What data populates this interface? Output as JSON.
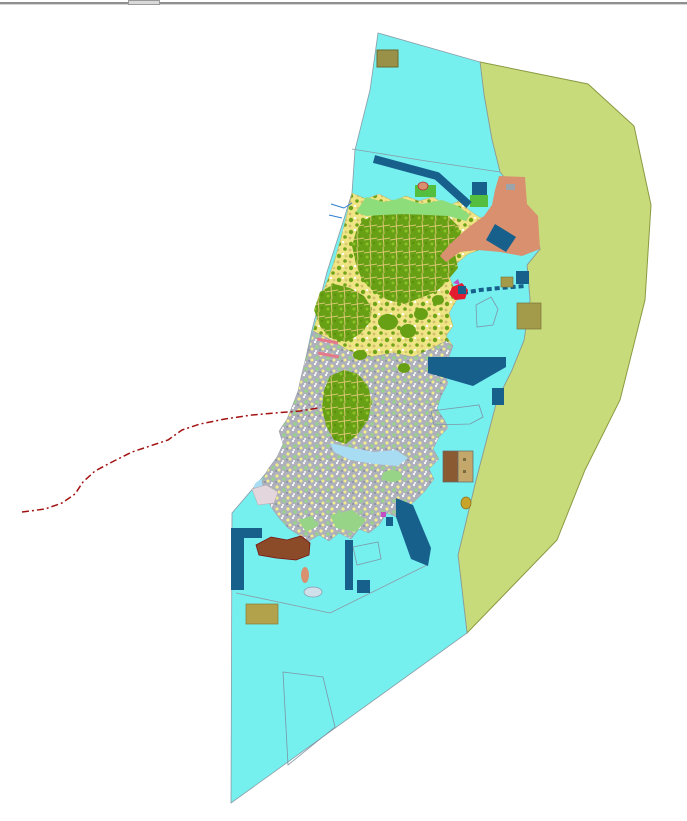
{
  "window": {
    "top_bar": {
      "handle": "window-resize-handle"
    }
  },
  "map": {
    "canvas": {
      "width": 687,
      "height": 821,
      "background": "#ffffff"
    },
    "palette": {
      "water": "#76EFEF",
      "reef": "#C7DB7B",
      "reef_border": "#8A9A42",
      "outline": "#8B9BA6",
      "harbor_blue": "#17608C",
      "salmon": "#D8906F",
      "khaki": "#A39A4A",
      "khaki_dark": "#9A9148",
      "khaki_light": "#B2A24B",
      "forest": "#67A014",
      "green_bright": "#54BE3E",
      "green_light": "#8EDD7B",
      "green_pale": "#98D488",
      "pale_blue": "#A8DCF2",
      "pale_pink": "#E3D6DC",
      "brown": "#8C4B28",
      "building_brown": "#8A5A33",
      "building_tan": "#C4A86B",
      "red_line": "#A31212",
      "pink_line": "#E4798C",
      "magenta": "#C24FC2",
      "red_feature": "#E31B2E",
      "stream_blue": "#2E7FD0",
      "gold": "#C9A42B"
    },
    "shapes": [
      {
        "name": "reef-zone",
        "kind": "polygon",
        "points": "480,62 484,95 492,140 500,172 510,185 520,200 532,215 540,249 527,265 530,300 524,340 512,370 497,400 476,480 458,555 467,633 557,540 585,470 620,400 645,300 651,205 634,126 588,84",
        "fill": "@reef",
        "stroke": "@reef_border",
        "sw": 1,
        "interactable": true
      },
      {
        "name": "lagoon-water",
        "kind": "polygon",
        "points": "378,33 480,62 484,95 492,140 500,172 510,185 520,200 532,215 540,249 527,265 530,300 524,340 512,370 497,400 476,480 458,555 467,633 231,803 232,513 262,478 305,425 300,385 312,330 327,272 343,222 352,193 355,150 370,90",
        "fill": "@water",
        "stroke": "@outline",
        "sw": 0.8,
        "interactable": true
      },
      {
        "name": "boundary-line-north",
        "kind": "polyline",
        "points": "352,149 420,160 500,172",
        "stroke": "@outline",
        "sw": 0.8,
        "interactable": false
      },
      {
        "name": "boundary-line-south",
        "kind": "polyline",
        "points": "236,593 330,613 427,565",
        "stroke": "@outline",
        "sw": 0.8,
        "interactable": false
      },
      {
        "name": "coastal-shallow-west-1",
        "kind": "ellipse",
        "cx": 270,
        "cy": 487,
        "rx": 16,
        "ry": 9,
        "fill": "@pale_blue",
        "interactable": false
      },
      {
        "name": "coastal-shallow-west-2",
        "kind": "ellipse",
        "cx": 291,
        "cy": 501,
        "rx": 12,
        "ry": 7,
        "fill": "@pale_blue",
        "interactable": false
      },
      {
        "name": "island-north",
        "kind": "polygon",
        "points": "352,193 366,199 379,194 393,201 406,196 419,201 433,197 448,206 459,201 469,210 479,217 492,220 497,228 489,238 479,250 468,254 456,264 449,276 453,286 463,293 456,301 449,313 453,326 446,336 453,346 446,341 431,349 413,357 393,353 371,357 349,351 331,340 313,331 318,314 321,297 328,279 335,259 341,238 346,218",
        "fill": "pattern:landmix",
        "stroke": "#b8b070",
        "sw": 0.5,
        "interactable": true
      },
      {
        "name": "island-south",
        "kind": "polygon",
        "points": "313,331 331,340 349,351 371,357 393,353 413,357 431,349 446,341 453,346 448,359 443,371 448,383 441,396 437,409 445,421 448,428 439,437 433,449 439,459 429,469 434,479 425,491 415,501 405,509 397,517 387,513 379,525 369,533 359,529 351,539 339,533 329,541 319,535 309,541 297,534 288,528 279,518 271,507 265,494 262,481 268,469 277,457 283,444 279,431 287,419 293,404 298,391 301,377 305,361 309,347",
        "fill": "pattern:urban",
        "stroke": "#9aa0a8",
        "sw": 0.5,
        "interactable": true
      },
      {
        "name": "inlet-shallow",
        "kind": "polygon",
        "points": "330,443 352,448 374,452 396,450 408,458 398,466 374,464 350,460 334,452",
        "fill": "@pale_blue",
        "interactable": false
      },
      {
        "name": "forest-patch-north-1",
        "kind": "polygon",
        "points": "362,221 378,213 396,210 414,214 432,210 448,216 458,226 462,240 455,254 458,268 448,280 436,292 420,298 404,304 388,300 374,292 362,280 356,264 352,246 356,232",
        "fill": "pattern:forest",
        "interactable": false
      },
      {
        "name": "forest-patch-north-2",
        "kind": "polygon",
        "points": "320,292 334,284 350,288 364,296 372,308 370,322 360,334 346,342 330,338 320,326 314,310",
        "fill": "pattern:forest",
        "interactable": false
      },
      {
        "name": "forest-patch-center",
        "kind": "polygon",
        "points": "330,376 344,370 358,374 368,386 372,402 368,420 358,434 346,444 334,440 326,426 322,408 324,390",
        "fill": "pattern:forest",
        "interactable": false
      },
      {
        "name": "forest-patch-small-1",
        "kind": "ellipse",
        "cx": 388,
        "cy": 322,
        "rx": 10,
        "ry": 8,
        "fill": "@forest",
        "interactable": false
      },
      {
        "name": "forest-patch-small-2",
        "kind": "ellipse",
        "cx": 408,
        "cy": 331,
        "rx": 8,
        "ry": 7,
        "fill": "@forest",
        "interactable": false
      },
      {
        "name": "forest-patch-small-3",
        "kind": "ellipse",
        "cx": 421,
        "cy": 314,
        "rx": 7,
        "ry": 6,
        "fill": "@forest",
        "interactable": false
      },
      {
        "name": "forest-patch-small-4",
        "kind": "ellipse",
        "cx": 438,
        "cy": 300,
        "rx": 6,
        "ry": 5,
        "fill": "@forest",
        "interactable": false
      },
      {
        "name": "forest-patch-small-5",
        "kind": "ellipse",
        "cx": 360,
        "cy": 355,
        "rx": 7,
        "ry": 5,
        "fill": "@forest",
        "interactable": false
      },
      {
        "name": "forest-patch-small-6",
        "kind": "ellipse",
        "cx": 404,
        "cy": 368,
        "rx": 6,
        "ry": 5,
        "fill": "@forest",
        "interactable": false
      },
      {
        "name": "coast-strip-green",
        "kind": "polygon",
        "points": "356,212 366,197 384,202 402,198 422,204 442,200 458,206 470,215 466,221 448,216 428,215 404,214 382,215 366,216",
        "fill": "@green_light",
        "interactable": false
      },
      {
        "name": "coastal-zone-northeast",
        "kind": "polygon",
        "points": "499,176 525,177 527,204 538,216 540,249 522,256 500,252 478,250 460,252 446,262 440,256 450,244 462,233 473,224 484,216 492,205 495,190",
        "fill": "@salmon",
        "interactable": true
      },
      {
        "name": "smudge-gray",
        "kind": "rect",
        "x": 506,
        "y": 184,
        "w": 9,
        "h": 6,
        "fill": "#9aa4aa",
        "interactable": false
      },
      {
        "name": "green-parcel-1",
        "kind": "rect",
        "x": 415,
        "y": 185,
        "w": 21,
        "h": 12,
        "fill": "@green_bright",
        "interactable": false
      },
      {
        "name": "green-parcel-2",
        "kind": "rect",
        "x": 470,
        "y": 195,
        "w": 18,
        "h": 12,
        "fill": "@green_bright",
        "interactable": false
      },
      {
        "name": "green-patch-south-1",
        "kind": "polygon",
        "points": "330,515 352,510 366,520 356,532 336,528",
        "fill": "@green_pale",
        "interactable": false
      },
      {
        "name": "green-patch-south-2",
        "kind": "polygon",
        "points": "298,520 312,516 318,526 306,532",
        "fill": "@green_pale",
        "interactable": false
      },
      {
        "name": "green-patch-south-3",
        "kind": "ellipse",
        "cx": 392,
        "cy": 476,
        "rx": 10,
        "ry": 6,
        "fill": "@green_pale",
        "interactable": false
      },
      {
        "name": "breakwater-northwest",
        "kind": "polyline",
        "points": "374,159 437,176 469,205",
        "stroke": "@harbor_blue",
        "sw": 8,
        "interactable": true
      },
      {
        "name": "marine-parcel-ne-1",
        "kind": "rect",
        "x": 472,
        "y": 182,
        "w": 15,
        "h": 13,
        "fill": "@harbor_blue",
        "interactable": false
      },
      {
        "name": "causeway",
        "kind": "polyline",
        "points": "463,293 480,290 500,288 525,286",
        "stroke": "@harbor_blue",
        "sw": 4,
        "dash": "5 3",
        "interactable": true
      },
      {
        "name": "marine-structure-ne",
        "kind": "rect",
        "x": 516,
        "y": 271,
        "w": 13,
        "h": 13,
        "fill": "@harbor_blue",
        "interactable": true
      },
      {
        "name": "khaki-parcel-small",
        "kind": "rect",
        "x": 501,
        "y": 277,
        "w": 12,
        "h": 10,
        "fill": "@khaki",
        "stroke": "#7a7238",
        "sw": 0.6,
        "interactable": false
      },
      {
        "name": "harbor-band-in-salmon",
        "kind": "polygon",
        "points": "495,224 516,237 506,252 486,240",
        "fill": "@harbor_blue",
        "interactable": false
      },
      {
        "name": "harbor-east",
        "kind": "polygon",
        "points": "428,357 506,357 506,367 473,386 428,373",
        "fill": "@harbor_blue",
        "interactable": true
      },
      {
        "name": "harbor-east-annex",
        "kind": "rect",
        "x": 492,
        "y": 388,
        "w": 12,
        "h": 17,
        "fill": "@harbor_blue",
        "interactable": false
      },
      {
        "name": "facility-building-west",
        "kind": "rect",
        "x": 443,
        "y": 451,
        "w": 15,
        "h": 31,
        "fill": "@building_brown",
        "stroke": "#666666",
        "sw": 0.7,
        "interactable": true
      },
      {
        "name": "facility-building-east",
        "kind": "rect",
        "x": 458,
        "y": 451,
        "w": 15,
        "h": 31,
        "fill": "@building_tan",
        "stroke": "#666666",
        "sw": 0.7,
        "interactable": true
      },
      {
        "name": "facility-dot-1",
        "kind": "rect",
        "x": 463,
        "y": 458,
        "w": 3,
        "h": 3,
        "fill": "#7a6a40",
        "interactable": false
      },
      {
        "name": "facility-dot-2",
        "kind": "rect",
        "x": 463,
        "y": 470,
        "w": 3,
        "h": 3,
        "fill": "#7a6a40",
        "interactable": false
      },
      {
        "name": "khaki-parcel-large",
        "kind": "rect",
        "x": 517,
        "y": 303,
        "w": 24,
        "h": 26,
        "fill": "@khaki",
        "stroke": "#7a7238",
        "sw": 0.7,
        "interactable": true
      },
      {
        "name": "boundary-polygon-pentagon",
        "kind": "polygon",
        "points": "476,305 491,297 498,309 493,325 477,327",
        "fill": "none",
        "stroke": "#7D96A6",
        "sw": 0.8,
        "interactable": false
      },
      {
        "name": "boundary-polygon-east",
        "kind": "polygon",
        "points": "431,411 479,405 483,417 470,424 434,425",
        "fill": "none",
        "stroke": "#7D96A6",
        "sw": 0.8,
        "interactable": false
      },
      {
        "name": "boundary-polygon-south",
        "kind": "polygon",
        "points": "353,547 378,542 381,559 357,565",
        "fill": "none",
        "stroke": "#7D96A6",
        "sw": 0.8,
        "interactable": false
      },
      {
        "name": "boundary-polygon-bottom",
        "kind": "polygon",
        "points": "283,672 323,677 335,727 288,765",
        "fill": "none",
        "stroke": "#7D96A6",
        "sw": 0.8,
        "interactable": false
      },
      {
        "name": "breakwater-south",
        "kind": "polygon",
        "points": "396,498 413,505 431,548 428,566 411,559 396,517",
        "fill": "@harbor_blue",
        "interactable": true
      },
      {
        "name": "pier-south",
        "kind": "rect",
        "x": 345,
        "y": 540,
        "w": 8,
        "h": 50,
        "fill": "@harbor_blue",
        "interactable": true
      },
      {
        "name": "marine-block-south",
        "kind": "rect",
        "x": 357,
        "y": 580,
        "w": 13,
        "h": 13,
        "fill": "@harbor_blue",
        "interactable": true
      },
      {
        "name": "breakwater-west",
        "kind": "polygon",
        "points": "231,528 262,528 262,538 244,538 244,590 231,590",
        "fill": "@harbor_blue",
        "interactable": true
      },
      {
        "name": "port-area-brown",
        "kind": "polygon",
        "points": "256,545 271,537 287,540 301,536 310,543 309,555 296,560 276,558 259,555",
        "fill": "@brown",
        "stroke": "#7A1010",
        "sw": 0.8,
        "interactable": true
      },
      {
        "name": "khaki-parcel-bottom",
        "kind": "rect",
        "x": 246,
        "y": 604,
        "w": 32,
        "h": 20,
        "fill": "@khaki_light",
        "stroke": "#857a38",
        "sw": 0.7,
        "interactable": true
      },
      {
        "name": "khaki-parcel-north",
        "kind": "rect",
        "x": 377,
        "y": 50,
        "w": 21,
        "h": 17,
        "fill": "@khaki_dark",
        "stroke": "#6E6A2E",
        "sw": 1,
        "interactable": true
      },
      {
        "name": "islet-pale",
        "kind": "ellipse",
        "cx": 313,
        "cy": 592,
        "rx": 9,
        "ry": 5,
        "fill": "#CFE0EA",
        "stroke": "#8899AA",
        "sw": 0.7,
        "interactable": false
      },
      {
        "name": "islet-salmon",
        "kind": "ellipse",
        "cx": 305,
        "cy": 575,
        "rx": 4,
        "ry": 8,
        "fill": "@salmon",
        "interactable": false
      },
      {
        "name": "shore-flat-pink",
        "kind": "polygon",
        "points": "252,489 266,485 278,492 274,503 258,505",
        "fill": "@pale_pink",
        "stroke": "#b8a8b0",
        "sw": 0.5,
        "interactable": false
      },
      {
        "name": "gold-feature",
        "kind": "ellipse",
        "cx": 466,
        "cy": 503,
        "rx": 5,
        "ry": 6,
        "fill": "@gold",
        "stroke": "#8A6D1A",
        "sw": 0.7,
        "interactable": false
      },
      {
        "name": "port-feature-red",
        "kind": "polygon",
        "points": "452,287 462,283 468,290 465,299 455,300 449,294",
        "fill": "@red_feature",
        "interactable": false
      },
      {
        "name": "port-feature-navy",
        "kind": "rect",
        "x": 458,
        "y": 286,
        "w": 8,
        "h": 8,
        "fill": "@harbor_blue",
        "interactable": false
      },
      {
        "name": "port-feature-magenta",
        "kind": "polygon",
        "points": "453,283 458,279 460,285",
        "fill": "@magenta",
        "interactable": false
      },
      {
        "name": "salmon-dot-north",
        "kind": "ellipse",
        "cx": 423,
        "cy": 186,
        "rx": 5,
        "ry": 4,
        "fill": "@salmon",
        "stroke": "#B03030",
        "sw": 0.8,
        "interactable": false
      },
      {
        "name": "stream-1",
        "kind": "polyline",
        "points": "331,204 344,208 352,203",
        "stroke": "@stream_blue",
        "sw": 1,
        "interactable": false
      },
      {
        "name": "stream-2",
        "kind": "polyline",
        "points": "329,215 342,218",
        "stroke": "@stream_blue",
        "sw": 1,
        "interactable": false
      },
      {
        "name": "pink-line-1",
        "kind": "polyline",
        "points": "317,339 338,343",
        "stroke": "@pink_line",
        "sw": 3,
        "interactable": false
      },
      {
        "name": "pink-line-2",
        "kind": "polyline",
        "points": "318,353 339,357",
        "stroke": "@pink_line",
        "sw": 3,
        "interactable": false
      },
      {
        "name": "magenta-dot-south",
        "kind": "rect",
        "x": 381,
        "y": 512,
        "w": 5,
        "h": 5,
        "fill": "@magenta",
        "interactable": false
      },
      {
        "name": "blue-dot-south",
        "kind": "rect",
        "x": 386,
        "y": 517,
        "w": 7,
        "h": 9,
        "fill": "@harbor_blue",
        "interactable": false
      },
      {
        "name": "dashed-route-line",
        "kind": "polyline",
        "points": "22,512 45,509 62,503 75,494 83,482 95,471 112,462 132,452 150,446 168,440 182,430 200,424 225,419 252,415 275,413 300,411 318,408",
        "stroke": "@red_line",
        "sw": 1.5,
        "dash": "7 3 2 3",
        "interactable": false
      }
    ]
  }
}
